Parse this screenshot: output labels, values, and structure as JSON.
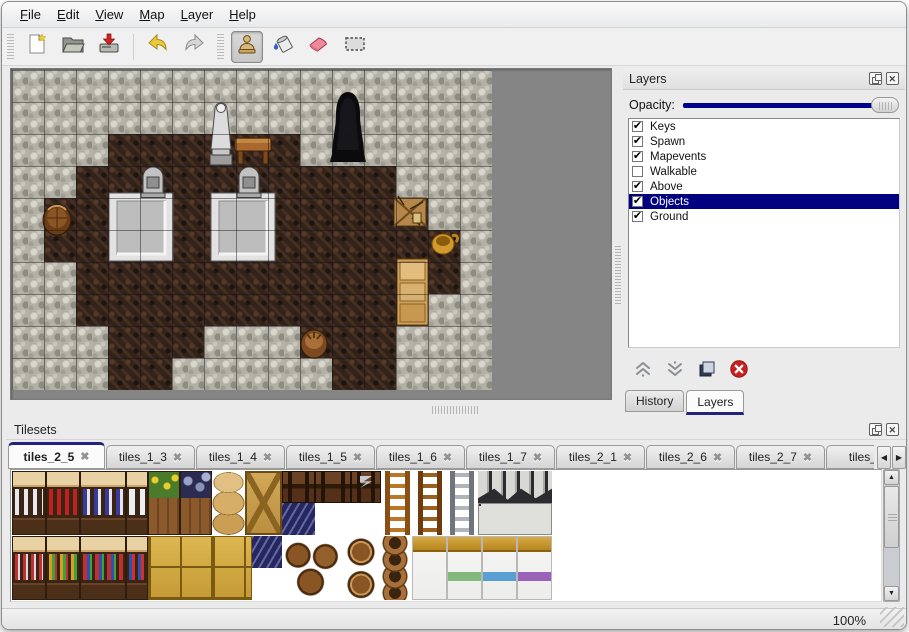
{
  "menu": {
    "items": [
      "File",
      "Edit",
      "View",
      "Map",
      "Layer",
      "Help"
    ]
  },
  "toolbar": {
    "buttons": [
      {
        "name": "new",
        "icon": "new-file-icon",
        "active": false
      },
      {
        "name": "open",
        "icon": "open-folder-icon",
        "active": false
      },
      {
        "name": "save",
        "icon": "save-icon",
        "active": false
      },
      {
        "name": "undo",
        "icon": "undo-icon",
        "active": false
      },
      {
        "name": "redo",
        "icon": "redo-icon",
        "active": false
      },
      {
        "name": "stamp-tool",
        "icon": "stamp-tool-icon",
        "active": true
      },
      {
        "name": "fill-tool",
        "icon": "fill-tool-icon",
        "active": false
      },
      {
        "name": "eraser-tool",
        "icon": "eraser-tool-icon",
        "active": false
      },
      {
        "name": "select-tool",
        "icon": "select-tool-icon",
        "active": false
      }
    ]
  },
  "layers_panel": {
    "title": "Layers",
    "titlebar_icons": [
      "float-icon",
      "close-icon"
    ],
    "opacity_label": "Opacity:",
    "opacity_fraction": 1.0,
    "layers": [
      {
        "label": "Keys",
        "checked": true,
        "selected": false
      },
      {
        "label": "Spawn",
        "checked": true,
        "selected": false
      },
      {
        "label": "Mapevents",
        "checked": true,
        "selected": false
      },
      {
        "label": "Walkable",
        "checked": false,
        "selected": false
      },
      {
        "label": "Above",
        "checked": true,
        "selected": false
      },
      {
        "label": "Objects",
        "checked": true,
        "selected": true
      },
      {
        "label": "Ground",
        "checked": true,
        "selected": false
      }
    ],
    "action_icons": [
      "raise-layer-icon",
      "lower-layer-icon",
      "duplicate-layer-icon",
      "delete-layer-icon"
    ],
    "tabs": [
      {
        "label": "History",
        "active": false
      },
      {
        "label": "Layers",
        "active": true
      }
    ]
  },
  "tilesets_panel": {
    "title": "Tilesets",
    "titlebar_icons": [
      "float-icon",
      "close-icon"
    ],
    "tabs": [
      {
        "label": "tiles_2_5",
        "active": true
      },
      {
        "label": "tiles_1_3",
        "active": false
      },
      {
        "label": "tiles_1_4",
        "active": false
      },
      {
        "label": "tiles_1_5",
        "active": false
      },
      {
        "label": "tiles_1_6",
        "active": false
      },
      {
        "label": "tiles_1_7",
        "active": false
      },
      {
        "label": "tiles_2_1",
        "active": false
      },
      {
        "label": "tiles_2_6",
        "active": false
      },
      {
        "label": "tiles_2_7",
        "active": false
      },
      {
        "label": "tiles_",
        "active": false
      }
    ],
    "scroll_icons": [
      "scroll-left-icon",
      "scroll-right-icon"
    ],
    "tiles": [
      {
        "kind": "shelf",
        "variant": "dishes",
        "x": 0,
        "y": 0,
        "w": 34,
        "h": 64
      },
      {
        "kind": "shelf",
        "variant": "red",
        "x": 34,
        "y": 0,
        "w": 34,
        "h": 64
      },
      {
        "kind": "shelf",
        "variant": "blue",
        "x": 68,
        "y": 0,
        "w": 46,
        "h": 64
      },
      {
        "kind": "shelf",
        "variant": "jugs",
        "x": 114,
        "y": 0,
        "w": 22,
        "h": 64
      },
      {
        "kind": "planter",
        "variant": "flowers",
        "x": 136,
        "y": 0,
        "w": 32,
        "h": 64
      },
      {
        "kind": "planter",
        "variant": "grapes",
        "x": 168,
        "y": 0,
        "w": 32,
        "h": 64
      },
      {
        "kind": "sackstack",
        "variant": "",
        "x": 200,
        "y": 0,
        "w": 33,
        "h": 64
      },
      {
        "kind": "cratex",
        "variant": "",
        "x": 233,
        "y": 0,
        "w": 37,
        "h": 64
      },
      {
        "kind": "chest",
        "variant": "plain",
        "x": 270,
        "y": 0,
        "w": 33,
        "h": 32
      },
      {
        "kind": "chest",
        "variant": "plain",
        "x": 303,
        "y": 0,
        "w": 36,
        "h": 32
      },
      {
        "kind": "chest",
        "variant": "silver",
        "x": 339,
        "y": 0,
        "w": 30,
        "h": 32
      },
      {
        "kind": "bluetile",
        "variant": "",
        "x": 270,
        "y": 32,
        "w": 33,
        "h": 32
      },
      {
        "kind": "ladder",
        "variant": "wood",
        "x": 369,
        "y": 0,
        "w": 33,
        "h": 64
      },
      {
        "kind": "ladder",
        "variant": "wood2",
        "x": 402,
        "y": 0,
        "w": 32,
        "h": 64
      },
      {
        "kind": "ladder",
        "variant": "steel",
        "x": 434,
        "y": 0,
        "w": 32,
        "h": 64
      },
      {
        "kind": "arch",
        "variant": "wall",
        "x": 466,
        "y": 0,
        "w": 74,
        "h": 32
      },
      {
        "kind": "arch",
        "variant": "doors",
        "x": 466,
        "y": 32,
        "w": 74,
        "h": 32
      },
      {
        "kind": "shelf",
        "variant": "food1",
        "x": 0,
        "y": 65,
        "w": 34,
        "h": 64
      },
      {
        "kind": "shelf",
        "variant": "food2",
        "x": 34,
        "y": 65,
        "w": 34,
        "h": 64
      },
      {
        "kind": "shelf",
        "variant": "food3",
        "x": 68,
        "y": 65,
        "w": 46,
        "h": 64
      },
      {
        "kind": "shelf",
        "variant": "food4",
        "x": 114,
        "y": 65,
        "w": 22,
        "h": 64
      },
      {
        "kind": "cratesY",
        "variant": "group",
        "x": 136,
        "y": 65,
        "w": 64,
        "h": 64
      },
      {
        "kind": "cratesY",
        "variant": "big",
        "x": 200,
        "y": 65,
        "w": 40,
        "h": 64
      },
      {
        "kind": "bluetile",
        "variant": "",
        "x": 240,
        "y": 65,
        "w": 30,
        "h": 32
      },
      {
        "kind": "barrels",
        "variant": "",
        "x": 270,
        "y": 65,
        "w": 62,
        "h": 64
      },
      {
        "kind": "barrelsingle",
        "variant": "",
        "x": 332,
        "y": 65,
        "w": 34,
        "h": 64
      },
      {
        "kind": "pots",
        "variant": "",
        "x": 366,
        "y": 65,
        "w": 34,
        "h": 64
      },
      {
        "kind": "bed",
        "variant": "plain",
        "x": 400,
        "y": 65,
        "w": 35,
        "h": 64
      },
      {
        "kind": "bed",
        "variant": "green",
        "x": 435,
        "y": 65,
        "w": 35,
        "h": 64
      },
      {
        "kind": "bed",
        "variant": "blue2",
        "x": 470,
        "y": 65,
        "w": 35,
        "h": 64
      },
      {
        "kind": "bed",
        "variant": "purple",
        "x": 505,
        "y": 65,
        "w": 35,
        "h": 64
      }
    ]
  },
  "map_view": {
    "tile_size": 32,
    "grid": [
      "...............",
      "...............",
      "...ffffff......",
      "..ffffffffff...",
      ".ffffffffffff..",
      ".fffffffffffff.",
      "..ffffffffffff.",
      "..fffffffffff..",
      "...fff...fff...",
      "...ff.....ff..."
    ],
    "objects": [
      {
        "kind": "cave",
        "x": 316,
        "y": 20,
        "w": 40,
        "h": 74
      },
      {
        "kind": "pedestal",
        "x": 96,
        "y": 122,
        "w": 66,
        "h": 70
      },
      {
        "kind": "pedestal",
        "x": 198,
        "y": 122,
        "w": 66,
        "h": 70
      },
      {
        "kind": "gravestone",
        "x": 128,
        "y": 94,
        "w": 26,
        "h": 34
      },
      {
        "kind": "gravestone",
        "x": 224,
        "y": 94,
        "w": 26,
        "h": 34
      },
      {
        "kind": "statue",
        "x": 195,
        "y": 30,
        "w": 28,
        "h": 66
      },
      {
        "kind": "table",
        "x": 222,
        "y": 66,
        "w": 38,
        "h": 30
      },
      {
        "kind": "barrel",
        "x": 30,
        "y": 130,
        "w": 30,
        "h": 36
      },
      {
        "kind": "crate_debris",
        "x": 380,
        "y": 124,
        "w": 36,
        "h": 34
      },
      {
        "kind": "pot_gold",
        "x": 418,
        "y": 158,
        "w": 30,
        "h": 28
      },
      {
        "kind": "cabinet",
        "x": 384,
        "y": 188,
        "w": 33,
        "h": 68
      },
      {
        "kind": "bucket",
        "x": 287,
        "y": 256,
        "w": 30,
        "h": 34
      }
    ],
    "colors": {
      "wall": "#b3b0a6",
      "floor": "#32231a",
      "viewport_bg": "#858585"
    }
  },
  "status_bar": {
    "zoom": "100%"
  },
  "theme": {
    "highlight": "#000080",
    "tab_accent": "#23237e",
    "slider_fill": "#00008c"
  }
}
